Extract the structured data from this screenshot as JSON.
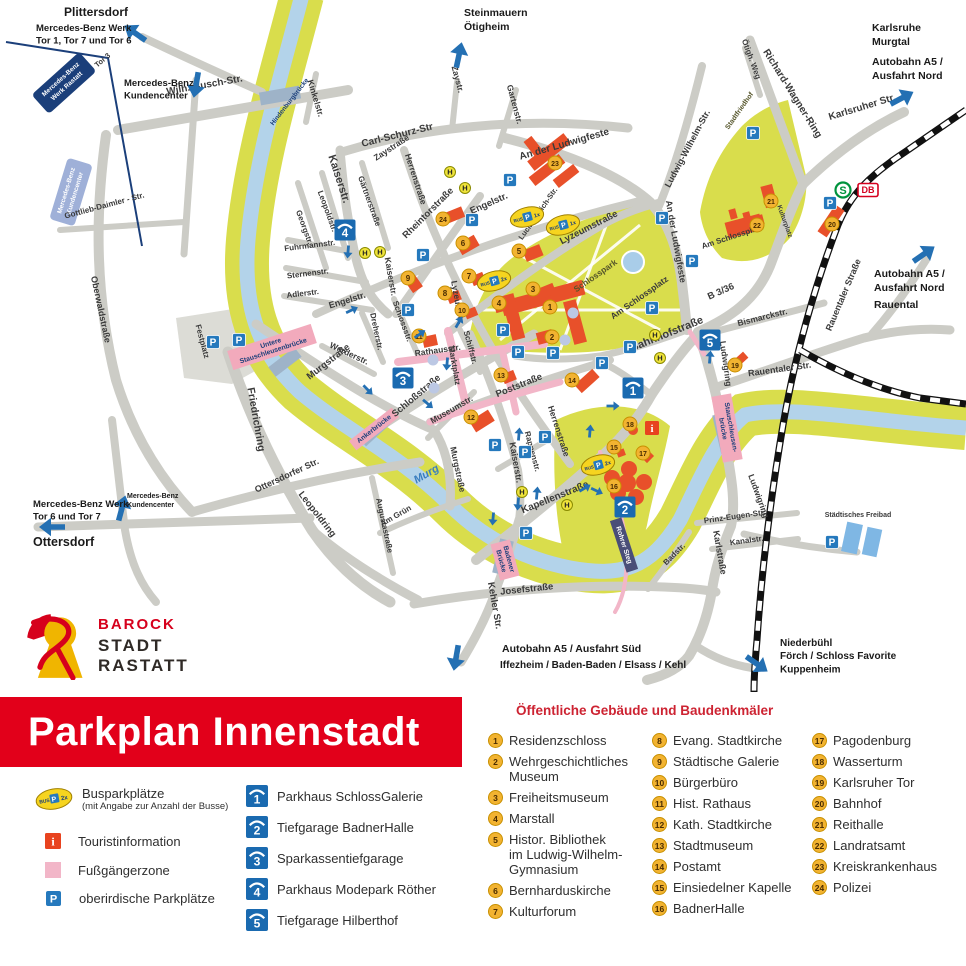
{
  "banner": {
    "title": "Parkplan Innenstadt"
  },
  "logo": {
    "l1": "BAROCK",
    "l2": "STADT",
    "l3": "RASTATT"
  },
  "legend": {
    "bus_label": "Busparkplätze",
    "bus_sub": "(mit Angabe zur Anzahl der Busse)",
    "bus_badge": {
      "bus": "BUS",
      "p": "P",
      "count": "2x"
    },
    "tourist": "Touristinformation",
    "pedestrian": "Fußgängerzone",
    "parking": "oberirdische Parkplätze",
    "garages": [
      {
        "n": "1",
        "label": "Parkhaus SchlossGalerie"
      },
      {
        "n": "2",
        "label": "Tiefgarage BadnerHalle"
      },
      {
        "n": "3",
        "label": "Sparkassentiefgarage"
      },
      {
        "n": "4",
        "label": "Parkhaus Modepark Röther"
      },
      {
        "n": "5",
        "label": "Tiefgarage Hilberthof"
      }
    ]
  },
  "buildings": {
    "heading": "Öffentliche Gebäude und Baudenkmäler",
    "columns": [
      [
        {
          "n": "1",
          "label": "Residenzschloss"
        },
        {
          "n": "2",
          "label": "Wehrgeschichtliches\nMuseum"
        },
        {
          "n": "3",
          "label": "Freiheitsmuseum"
        },
        {
          "n": "4",
          "label": "Marstall"
        },
        {
          "n": "5",
          "label": "Histor. Bibliothek\nim Ludwig-Wilhelm-\nGymnasium"
        },
        {
          "n": "6",
          "label": "Bernharduskirche"
        },
        {
          "n": "7",
          "label": "Kulturforum"
        }
      ],
      [
        {
          "n": "8",
          "label": "Evang. Stadtkirche"
        },
        {
          "n": "9",
          "label": "Städtische Galerie"
        },
        {
          "n": "10",
          "label": "Bürgerbüro"
        },
        {
          "n": "11",
          "label": "Hist. Rathaus"
        },
        {
          "n": "12",
          "label": "Kath. Stadtkirche"
        },
        {
          "n": "13",
          "label": "Stadtmuseum"
        },
        {
          "n": "14",
          "label": "Postamt"
        },
        {
          "n": "15",
          "label": "Einsiedelner Kapelle"
        },
        {
          "n": "16",
          "label": "BadnerHalle"
        }
      ],
      [
        {
          "n": "17",
          "label": "Pagodenburg"
        },
        {
          "n": "18",
          "label": "Wasserturm"
        },
        {
          "n": "19",
          "label": "Karlsruher Tor"
        },
        {
          "n": "20",
          "label": "Bahnhof"
        },
        {
          "n": "21",
          "label": "Reithalle"
        },
        {
          "n": "22",
          "label": "Landratsamt"
        },
        {
          "n": "23",
          "label": "Kreiskrankenhaus"
        },
        {
          "n": "24",
          "label": "Polizei"
        }
      ]
    ]
  },
  "map": {
    "edge_labels": [
      {
        "lines": [
          "Plittersdorf"
        ],
        "x": 64,
        "y": 16,
        "size": 12
      },
      {
        "lines": [
          "Mercedes-Benz Werk",
          "Tor 1, Tor 7 und Tor 6"
        ],
        "x": 36,
        "y": 31,
        "size": 9.5
      },
      {
        "lines": [
          "Mercedes-Benz",
          "Kundencenter"
        ],
        "x": 124,
        "y": 86,
        "size": 9.5
      },
      {
        "lines": [
          "Steinmauern",
          "Ötigheim"
        ],
        "x": 464,
        "y": 16,
        "size": 10.5
      },
      {
        "lines": [
          "Karlsruhe",
          "Murgtal"
        ],
        "x": 872,
        "y": 31,
        "size": 10.5
      },
      {
        "lines": [
          "Autobahn A5 /",
          "Ausfahrt Nord"
        ],
        "x": 872,
        "y": 65,
        "size": 10.5
      },
      {
        "lines": [
          "Autobahn A5 /",
          "Ausfahrt Nord"
        ],
        "x": 874,
        "y": 277,
        "size": 10.5
      },
      {
        "lines": [
          "Rauental"
        ],
        "x": 874,
        "y": 308,
        "size": 10.5
      },
      {
        "lines": [
          "Mercedes-Benz Werk",
          "Tor 6 und Tor 7"
        ],
        "x": 33,
        "y": 507,
        "size": 9.5
      },
      {
        "lines": [
          "Ottersdorf"
        ],
        "x": 33,
        "y": 546,
        "size": 12.5
      },
      {
        "lines": [
          "Mercedes-Benz",
          "Kundencenter"
        ],
        "x": 127,
        "y": 498,
        "size": 7
      },
      {
        "lines": [
          "Autobahn A5 / Ausfahrt Süd"
        ],
        "x": 502,
        "y": 652,
        "size": 10.5
      },
      {
        "lines": [
          "Iffezheim / Baden-Baden / Elsass / Kehl"
        ],
        "x": 500,
        "y": 668,
        "size": 10
      },
      {
        "lines": [
          "Niederbühl",
          "Förch / Schloss Favorite",
          "Kuppenheim"
        ],
        "x": 780,
        "y": 646,
        "size": 10
      }
    ],
    "streets": [
      [
        "Wilh.-Busch-Str.",
        205,
        88,
        -10,
        10
      ],
      [
        "Kinkelstr.",
        313,
        99,
        73,
        8.5
      ],
      [
        "Carl-Schurz-Str",
        398,
        138,
        -14,
        10
      ],
      [
        "Zaystr.",
        455,
        80,
        75,
        8.5
      ],
      [
        "Zaystraße",
        393,
        150,
        -33,
        8.5
      ],
      [
        "Herrenstraße",
        413,
        180,
        72,
        8.5
      ],
      [
        "Gartenstr.",
        512,
        105,
        75,
        8.5
      ],
      [
        "An der Ludwigfeste",
        565,
        147,
        -16,
        10
      ],
      [
        "Ötigh. Weg",
        749,
        60,
        70,
        8
      ],
      [
        "Richard-Wagner-Ring",
        790,
        95,
        58,
        10
      ],
      [
        "Karlsruher Str.",
        863,
        110,
        -17,
        10
      ],
      [
        "Ludwig-Wilhelm-Str.",
        690,
        150,
        -62,
        9
      ],
      [
        "An der Ludwigfeste",
        673,
        242,
        80,
        9
      ],
      [
        "Stadtfriedhof",
        741,
        112,
        -55,
        7,
        "park"
      ],
      [
        "Kaiserstr.",
        336,
        180,
        72,
        11
      ],
      [
        "Gärtnerstraße",
        367,
        202,
        70,
        8
      ],
      [
        "Leopoldstr.",
        325,
        212,
        70,
        8
      ],
      [
        "Georgstr.",
        302,
        228,
        70,
        8
      ],
      [
        "Fuhrmannstr.",
        310,
        248,
        -7,
        8
      ],
      [
        "Sternenstr.",
        308,
        276,
        -7,
        8
      ],
      [
        "Adlerstr.",
        303,
        296,
        -7,
        8
      ],
      [
        "Engelstr.",
        490,
        206,
        -24,
        9.5
      ],
      [
        "Lucian-Reich-Str.",
        540,
        215,
        -55,
        7.5
      ],
      [
        "Rheintorstraße",
        430,
        215,
        -45,
        9.5
      ],
      [
        "Lyzeumstraße",
        590,
        230,
        -27,
        9.5
      ],
      [
        "Lyzeumstr.",
        455,
        303,
        80,
        8.5
      ],
      [
        "Engelstr.",
        348,
        303,
        -17,
        9
      ],
      [
        "Dreherstr.",
        374,
        332,
        78,
        8
      ],
      [
        "Schlossstr.",
        400,
        322,
        70,
        8
      ],
      [
        "Kaiserstr.",
        388,
        277,
        80,
        8.5
      ],
      [
        "Werderstr.",
        348,
        356,
        25,
        8.5
      ],
      [
        "Rathausstr.",
        438,
        353,
        -8,
        8.5
      ],
      [
        "Marktplatz",
        452,
        366,
        80,
        8
      ],
      [
        "Schiffstr.",
        468,
        348,
        75,
        8
      ],
      [
        "Museumstr.",
        453,
        412,
        -30,
        8.5
      ],
      [
        "Poststraße",
        520,
        388,
        -22,
        9.5
      ],
      [
        "Herrenstraße",
        556,
        432,
        72,
        8.5
      ],
      [
        "Rappenstr.",
        530,
        452,
        75,
        8
      ],
      [
        "Kaiserstr.",
        513,
        463,
        80,
        9
      ],
      [
        "Kapellenstraße",
        556,
        500,
        -22,
        10
      ],
      [
        "Murgstraße",
        330,
        364,
        -38,
        9.5
      ],
      [
        "Schloßstraße",
        418,
        398,
        -40,
        9.5
      ],
      [
        "Friedrichring",
        253,
        420,
        80,
        10.5
      ],
      [
        "Murgstraße",
        455,
        470,
        78,
        8.5
      ],
      [
        "Am Grün",
        397,
        518,
        -30,
        8
      ],
      [
        "Augustastraße",
        382,
        526,
        78,
        8
      ],
      [
        "Ottersdorfer Str.",
        288,
        478,
        -25,
        9
      ],
      [
        "Leopoldring",
        315,
        516,
        52,
        9.5
      ],
      [
        "Oberwaldstraße",
        98,
        310,
        78,
        9
      ],
      [
        "Festplatz",
        200,
        342,
        75,
        8
      ],
      [
        "Kehler Str.",
        492,
        606,
        80,
        9.5
      ],
      [
        "Josefstraße",
        527,
        592,
        -6,
        9.5
      ],
      [
        "Badstr.",
        676,
        556,
        -45,
        8
      ],
      [
        "Karlstraße",
        717,
        553,
        80,
        9
      ],
      [
        "Kanalstr.",
        747,
        543,
        -8,
        8
      ],
      [
        "Prinz-Eugen-Str.",
        735,
        519,
        -8,
        8
      ],
      [
        "Ludwigring",
        723,
        364,
        82,
        8.5
      ],
      [
        "Ludwigring",
        756,
        497,
        70,
        8.5
      ],
      [
        "Bahnhofstraße",
        668,
        337,
        -22,
        11
      ],
      [
        "B 3/36",
        722,
        294,
        -24,
        9.5
      ],
      [
        "Bismarckstr.",
        763,
        320,
        -14,
        8.5
      ],
      [
        "Rauentaler Str.",
        780,
        372,
        -8,
        9
      ],
      [
        "Rauentaler Straße",
        846,
        296,
        -67,
        9
      ],
      [
        "Am Schlossplatz",
        641,
        300,
        -35,
        8.5
      ],
      [
        "Am Schlossplatz",
        733,
        239,
        -18,
        8
      ],
      [
        "Schlosspark",
        597,
        278,
        -35,
        8.5,
        "park"
      ],
      [
        "Kulturplatz",
        783,
        222,
        70,
        6.5
      ],
      [
        "Murg",
        428,
        477,
        -30,
        11,
        "water"
      ],
      [
        "Gottlieb-Daimler - Str.",
        105,
        208,
        -15,
        8
      ],
      [
        "Tor 3",
        104,
        62,
        -40,
        7.5
      ],
      [
        "Hindenburgbrücke",
        291,
        103,
        -52,
        6.5,
        "navy"
      ],
      [
        "Städtisches Freibad",
        858,
        517,
        0,
        7
      ]
    ],
    "bridges": [
      {
        "lines": [
          "Untere",
          "Stauschleusenbrücke"
        ],
        "x": 272,
        "y": 347,
        "r": -18
      },
      {
        "lines": [
          "Ankerbrücke"
        ],
        "x": 374,
        "y": 429,
        "r": -38
      },
      {
        "lines": [
          "Badener",
          "Brücke"
        ],
        "x": 505,
        "y": 560,
        "r": 75
      },
      {
        "lines": [
          "Stauschleusen-",
          "brücke"
        ],
        "x": 727,
        "y": 428,
        "r": 80
      },
      {
        "lines": [
          "Rohrer Steg"
        ],
        "x": 624,
        "y": 545,
        "r": 72,
        "dark": true
      }
    ],
    "markers": [
      [
        1,
        550,
        307
      ],
      [
        2,
        552,
        337
      ],
      [
        3,
        533,
        289
      ],
      [
        4,
        499,
        303
      ],
      [
        5,
        519,
        251
      ],
      [
        6,
        463,
        243
      ],
      [
        7,
        469,
        276
      ],
      [
        8,
        445,
        293
      ],
      [
        9,
        408,
        278
      ],
      [
        10,
        462,
        310
      ],
      [
        11,
        419,
        336
      ],
      [
        12,
        471,
        417
      ],
      [
        13,
        501,
        375
      ],
      [
        14,
        572,
        380
      ],
      [
        15,
        614,
        447
      ],
      [
        16,
        614,
        486
      ],
      [
        17,
        643,
        453
      ],
      [
        18,
        630,
        424
      ],
      [
        19,
        735,
        365
      ],
      [
        20,
        832,
        224
      ],
      [
        21,
        771,
        201
      ],
      [
        22,
        757,
        225
      ],
      [
        23,
        555,
        163
      ],
      [
        24,
        443,
        219
      ]
    ],
    "garages": [
      [
        1,
        633,
        388
      ],
      [
        2,
        625,
        507
      ],
      [
        3,
        403,
        378
      ],
      [
        4,
        345,
        230
      ],
      [
        5,
        710,
        340
      ]
    ],
    "p": [
      [
        213,
        342
      ],
      [
        239,
        340
      ],
      [
        423,
        255
      ],
      [
        510,
        180
      ],
      [
        472,
        220
      ],
      [
        408,
        310
      ],
      [
        503,
        330
      ],
      [
        518,
        352
      ],
      [
        553,
        353
      ],
      [
        602,
        363
      ],
      [
        630,
        347
      ],
      [
        495,
        445
      ],
      [
        525,
        452
      ],
      [
        545,
        437
      ],
      [
        526,
        533
      ],
      [
        652,
        308
      ],
      [
        692,
        261
      ],
      [
        662,
        218
      ],
      [
        753,
        133
      ],
      [
        830,
        203
      ],
      [
        832,
        542
      ]
    ],
    "bus": [
      [
        527,
        217,
        "1x"
      ],
      [
        563,
        225,
        "1x"
      ],
      [
        494,
        281,
        "2x"
      ],
      [
        598,
        465,
        "2x"
      ]
    ],
    "h": [
      [
        450,
        172
      ],
      [
        465,
        188
      ],
      [
        365,
        253
      ],
      [
        380,
        252
      ],
      [
        522,
        492
      ],
      [
        567,
        505
      ],
      [
        655,
        335
      ],
      [
        660,
        358
      ]
    ],
    "info": [
      [
        652,
        428
      ]
    ],
    "dots": [
      [
        573,
        313
      ],
      [
        565,
        340
      ],
      [
        433,
        360
      ],
      [
        434,
        388
      ]
    ],
    "s_logo": {
      "x": 843,
      "y": 190,
      "t": "S"
    },
    "db_logo": {
      "x": 866,
      "y": 190,
      "t": "DB"
    },
    "big_arrows": [
      [
        135,
        33,
        -145
      ],
      [
        196,
        85,
        100
      ],
      [
        459,
        55,
        -78
      ],
      [
        902,
        98,
        -28
      ],
      [
        924,
        254,
        -35
      ],
      [
        52,
        527,
        180
      ],
      [
        122,
        508,
        -75
      ],
      [
        456,
        658,
        100
      ],
      [
        757,
        664,
        35
      ]
    ],
    "flow_arrows": [
      [
        348,
        252,
        95
      ],
      [
        420,
        334,
        -35
      ],
      [
        447,
        364,
        95
      ],
      [
        368,
        390,
        45
      ],
      [
        428,
        404,
        40
      ],
      [
        519,
        434,
        -85
      ],
      [
        493,
        519,
        95
      ],
      [
        537,
        493,
        -85
      ],
      [
        585,
        488,
        -30
      ],
      [
        590,
        431,
        -85
      ],
      [
        613,
        406,
        0
      ],
      [
        710,
        357,
        -85
      ],
      [
        597,
        491,
        25
      ],
      [
        352,
        310,
        -25
      ],
      [
        459,
        322,
        -60
      ],
      [
        518,
        504,
        95
      ]
    ],
    "boxes": [
      {
        "lines": [
          "Mercedes-Benz",
          "Werk Rastatt"
        ],
        "x": 64,
        "y": 83,
        "r": -42,
        "style": "navy"
      },
      {
        "lines": [
          "Mercedes-Benz",
          "Kundencenter"
        ],
        "x": 71,
        "y": 192,
        "r": -73,
        "style": "lav"
      }
    ]
  },
  "colors": {
    "banner_red": "#e2001a",
    "road": "#ccccc6",
    "river": "#b3d3ea",
    "bank": "#d9dd4c",
    "pedestrian_pink": "#f2b6c8",
    "building_orange": "#e8502a",
    "marker_yellow": "#f2b331",
    "parkhaus_blue": "#1a6ab0",
    "p_blue": "#2579bd",
    "arrow_blue": "#2470b3",
    "db_red": "#d5001e",
    "sbahn_green": "#00933d",
    "navy": "#1b3f7a",
    "heading_red": "#cd2332"
  }
}
